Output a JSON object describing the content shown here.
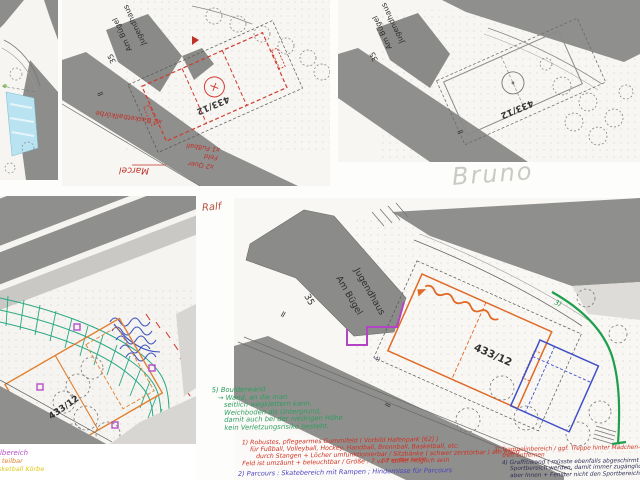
{
  "collage": {
    "parcel_number": "433/12",
    "road_mark": "=",
    "building": {
      "line1": "Jugendhaus",
      "line2": "Am Bügel",
      "line3": "35"
    },
    "names": {
      "marcel": "Marcel",
      "bruno": "Bruno",
      "ralf": "Ralf"
    },
    "panel_marcel": {
      "note_basketball": "x2 Basketballkörbe",
      "note_field1": "x1 Fußball",
      "note_field2": "Feld",
      "note_field3": "x2 Quer"
    },
    "panel_bottom_left": {
      "cutoff_magenta": "llbereich",
      "cutoff_orange": "l teilbar",
      "cutoff_yellow": "sketball Körbe"
    },
    "panel_ralf": {
      "marker_green": "3)",
      "marker_purple": "4)",
      "green_note": [
        "5) Boulderwand",
        "→ Wand, an die man",
        "seitlich wegklettern kann.",
        "Weichboden als Untergrund,",
        "damit auch bei der niedrigen Höhe",
        "kein Verletzungsrisiko besteht."
      ],
      "red_note": [
        "1) Robustes, pflegearmes Gummifeld ( Vorbild Hafenpark [62] )",
        "für Fußball, Volleyball, Hockey, Handball, Brennball, Basketball, etc.",
        "durch Stangen + Löcher umfunktionierbar / Sitzbänke ( schwer zerstörbar ) am Rand",
        "Feld ist umzäunt + beleuchtbar / Größe : 7 vs 7 sollte möglich sein"
      ],
      "red_note_insert": "für wertige Spiele",
      "blue_note": "2) Parcours : Skatebereich mit Rampen ; Hindernisse für Parcours",
      "red_note_right": [
        "3) Trampolinbereich / ggf. Treppe hinter Mädchen-",
        "treff entfernen"
      ],
      "dark_note_right": [
        "4) Graffitiwand ( müsste ebenfalls abgeschirmt vom",
        "Sportbereich werden, damit immer zugänglich,",
        "aber Innen + Fenster nicht den Sportbereich )"
      ]
    },
    "colors": {
      "red": "#c83232",
      "orange": "#e06a28",
      "green": "#1f9e4c",
      "teal": "#27a884",
      "blue": "#4050c8",
      "magenta": "#b84fc8",
      "yellow": "#ddc91c",
      "pencil": "#cbc9c3",
      "ink": "#2e2e55",
      "road_gray": "#8f8f8d"
    }
  }
}
